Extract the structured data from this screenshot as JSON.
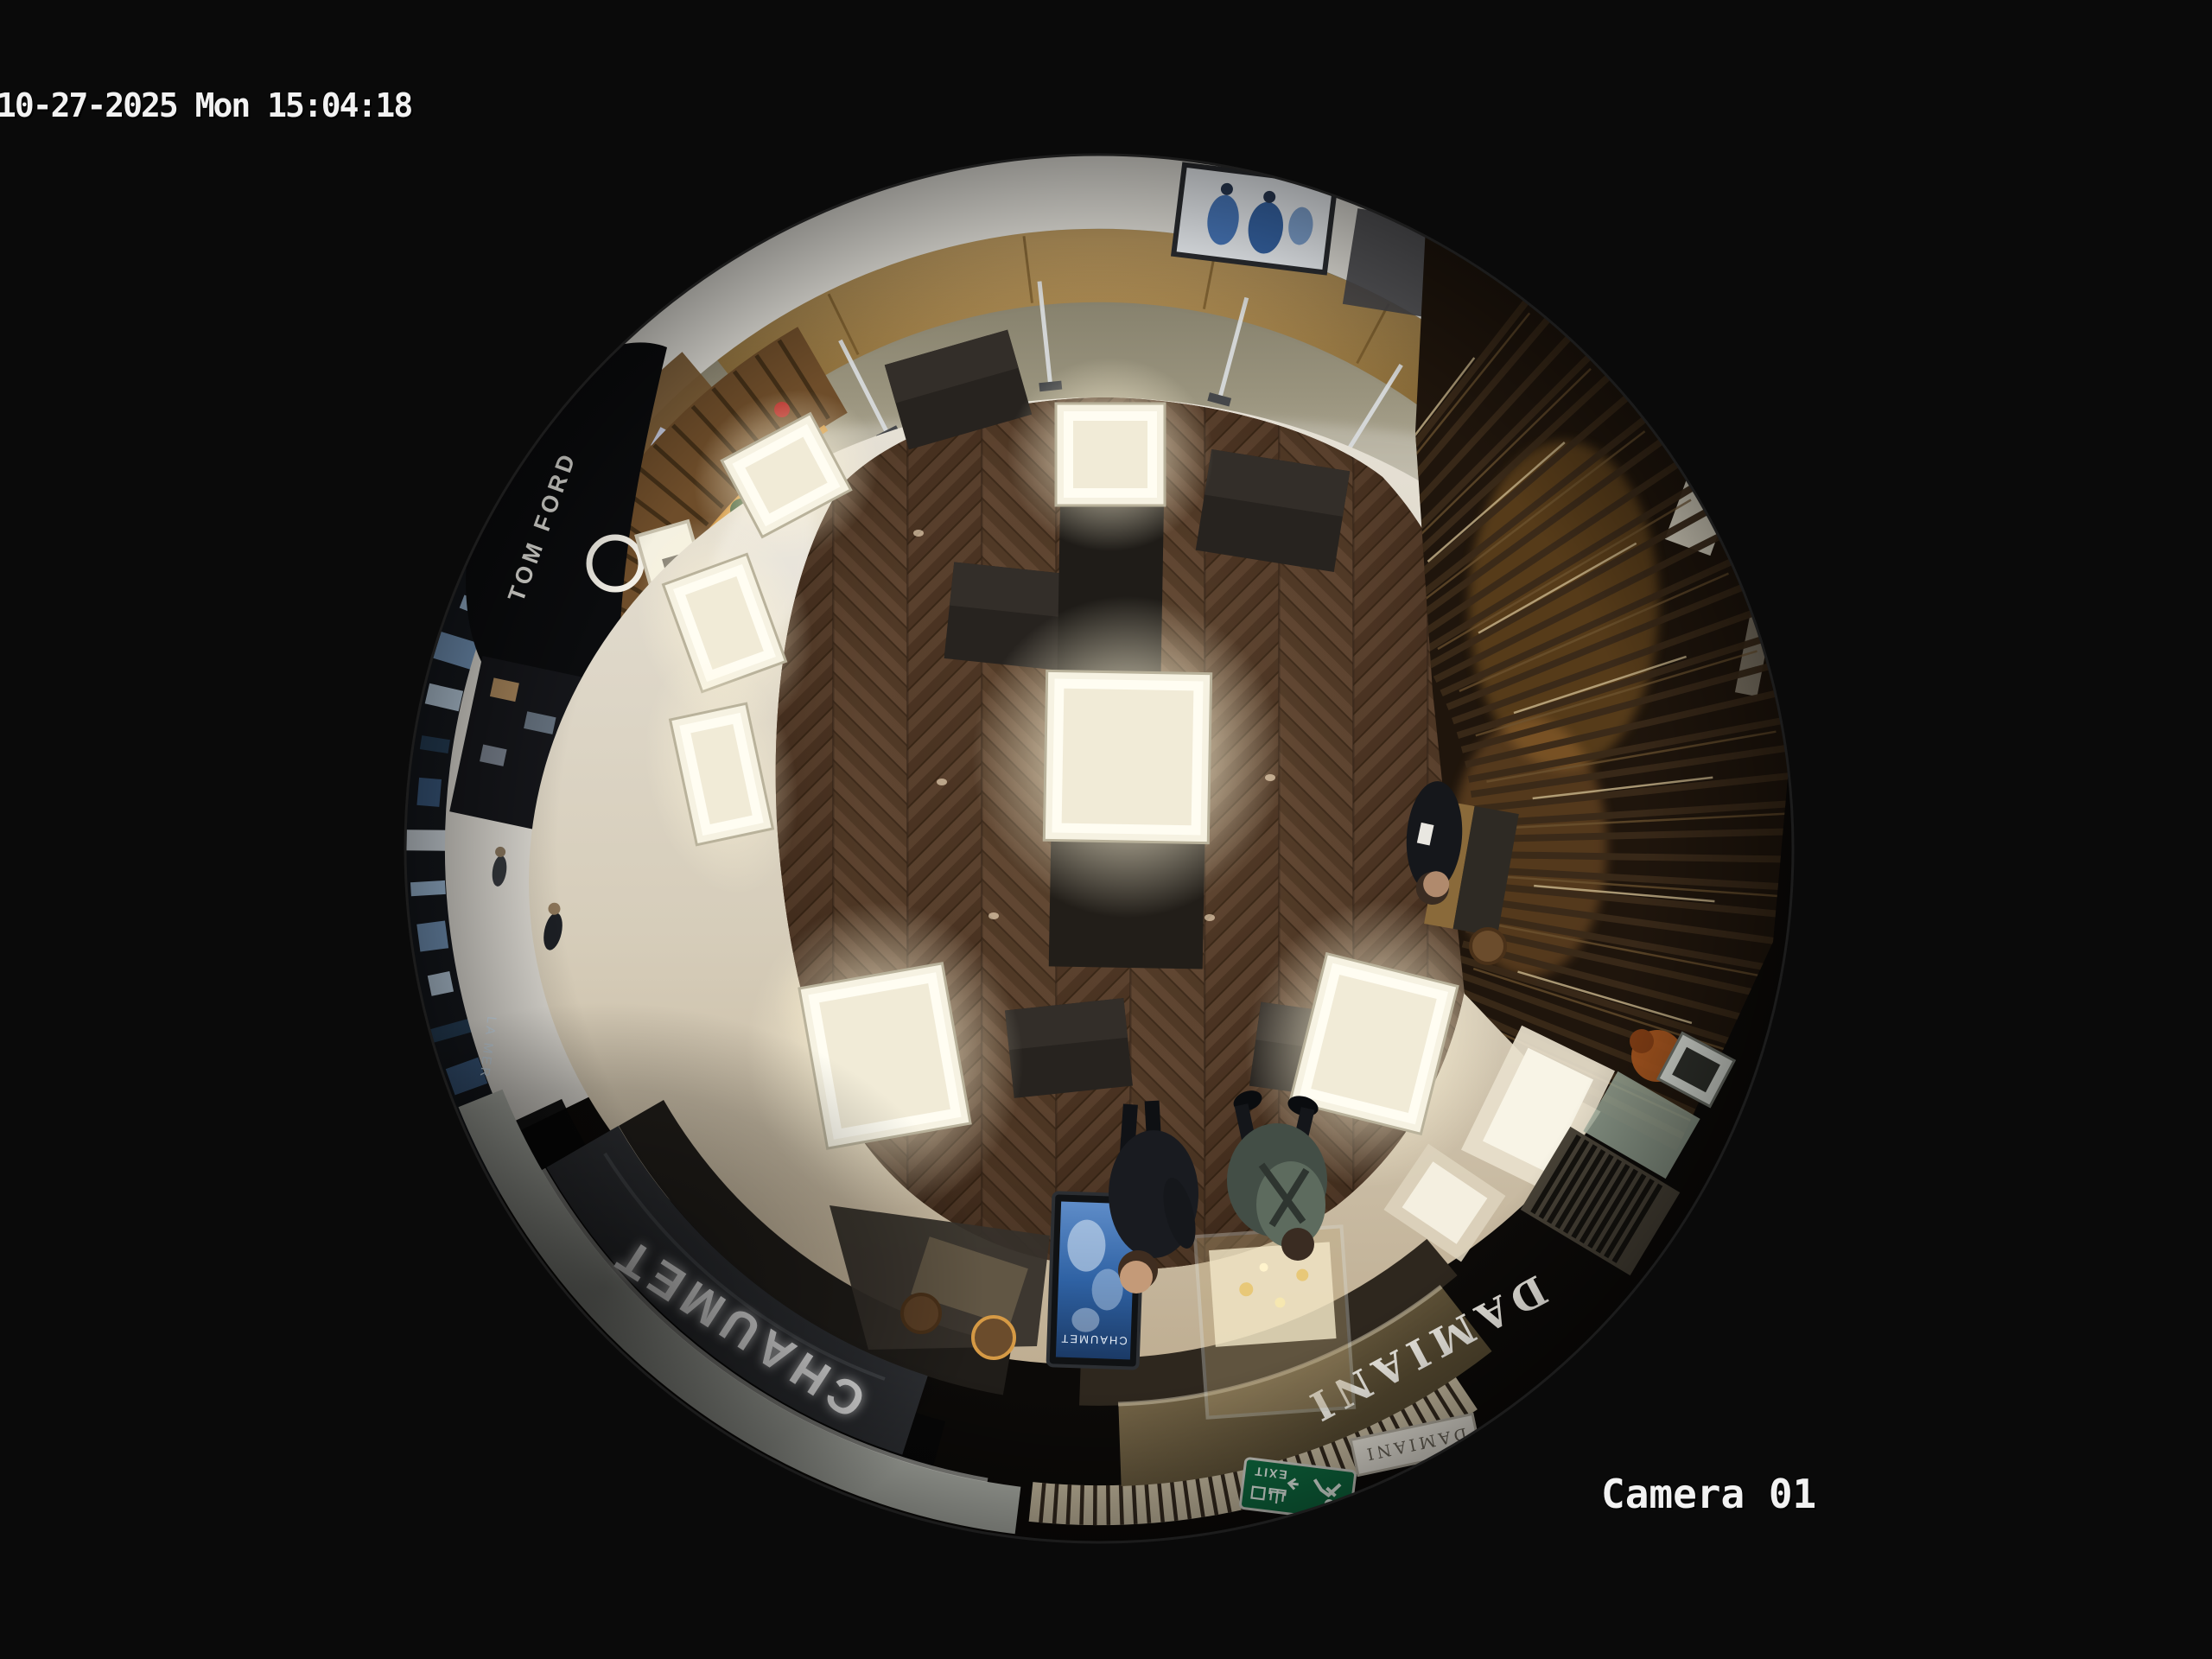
{
  "osd": {
    "timestamp": "10-27-2025 Mon 15:04:18",
    "camera_label": "Camera 01",
    "text_color": "#f2f2f2"
  },
  "scene": {
    "signs": {
      "chaumet_fascia": "CHAUMET",
      "damiani_fascia": "DAMIANI",
      "tom_ford_fascia": "TOM FORD",
      "damiani_small_sign": "DAMIANI",
      "kiosk_screen_brand": "CHAUMET",
      "la_mer_corridor_sign": "LA MER",
      "exit_sign_en": "EXIT",
      "exit_sign_zh": "出口"
    },
    "colors": {
      "background": "#0a0a0a",
      "wood_floor": "#53392a",
      "store_floor": "#d5cfc0",
      "corridor_marble": "#8f8a74",
      "ceiling_band": "#e7e5de",
      "gold_wall": "#8a6f42",
      "slat_wall": "#241813",
      "fascia_chaumet": "#2e3034",
      "fascia_damiani": "#7a6a50",
      "kiosk_screen_blue": "#2f62a4",
      "exit_green": "#0e6b40",
      "amber_accent": "#d69a45"
    }
  }
}
